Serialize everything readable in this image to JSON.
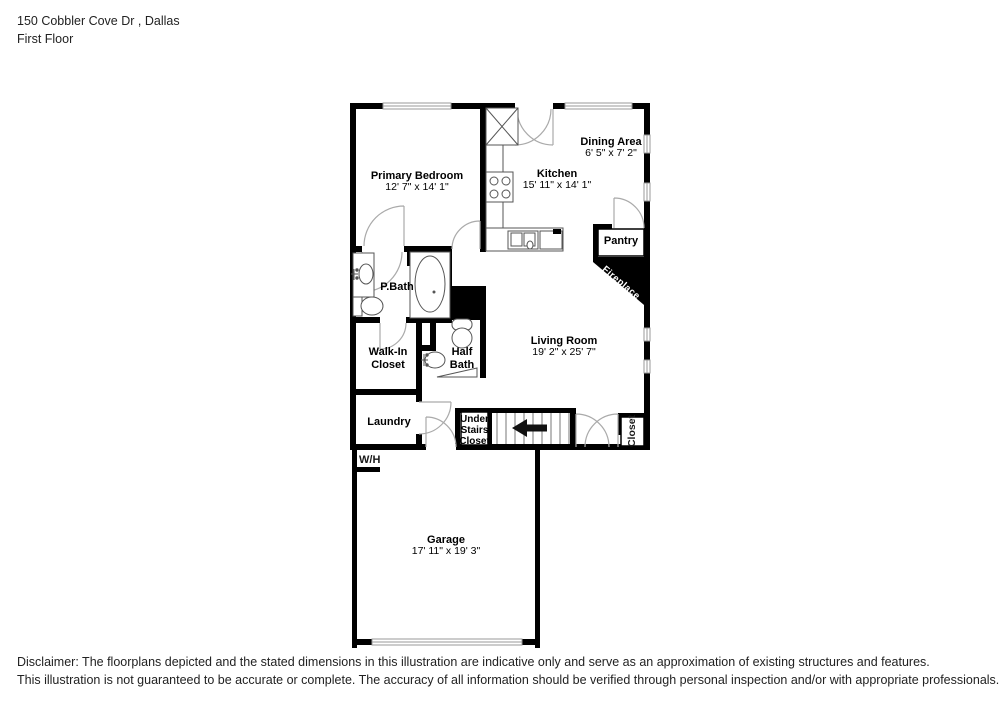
{
  "header": {
    "address": "150 Cobbler Cove Dr , Dallas",
    "floor": "First Floor"
  },
  "rooms": {
    "primary_bedroom": {
      "name": "Primary Bedroom",
      "dims": "12' 7\" x 14' 1\""
    },
    "kitchen": {
      "name": "Kitchen",
      "dims": "15' 11\" x 14' 1\""
    },
    "dining_area": {
      "name": "Dining Area",
      "dims": "6' 5\" x 7' 2\""
    },
    "pantry": {
      "name": "Pantry"
    },
    "fireplace": {
      "name": "Fireplace"
    },
    "p_bath": {
      "name": "P.Bath"
    },
    "walk_in_closet": {
      "name": "Walk-In Closet"
    },
    "half_bath": {
      "name": "Half Bath"
    },
    "living_room": {
      "name": "Living Room",
      "dims": "19' 2\" x 25' 7\""
    },
    "laundry": {
      "name": "Laundry"
    },
    "under_stairs": {
      "name": "Under Stairs Closet"
    },
    "closet": {
      "name": "Closet"
    },
    "water_heater": {
      "name": "W/H"
    },
    "garage": {
      "name": "Garage",
      "dims": "17' 11\" x 19' 3\""
    }
  },
  "colors": {
    "wall": "#000000",
    "fixture_line": "#555555",
    "door_arc": "#aaaaaa",
    "background": "#ffffff"
  },
  "disclaimer": {
    "line1": "Disclaimer: The floorplans depicted and the stated dimensions in this illustration are indicative only and serve as an approximation of existing structures and features.",
    "line2": "This illustration is not guaranteed to be accurate or complete. The accuracy of all information should be verified through personal inspection and/or with appropriate professionals."
  }
}
